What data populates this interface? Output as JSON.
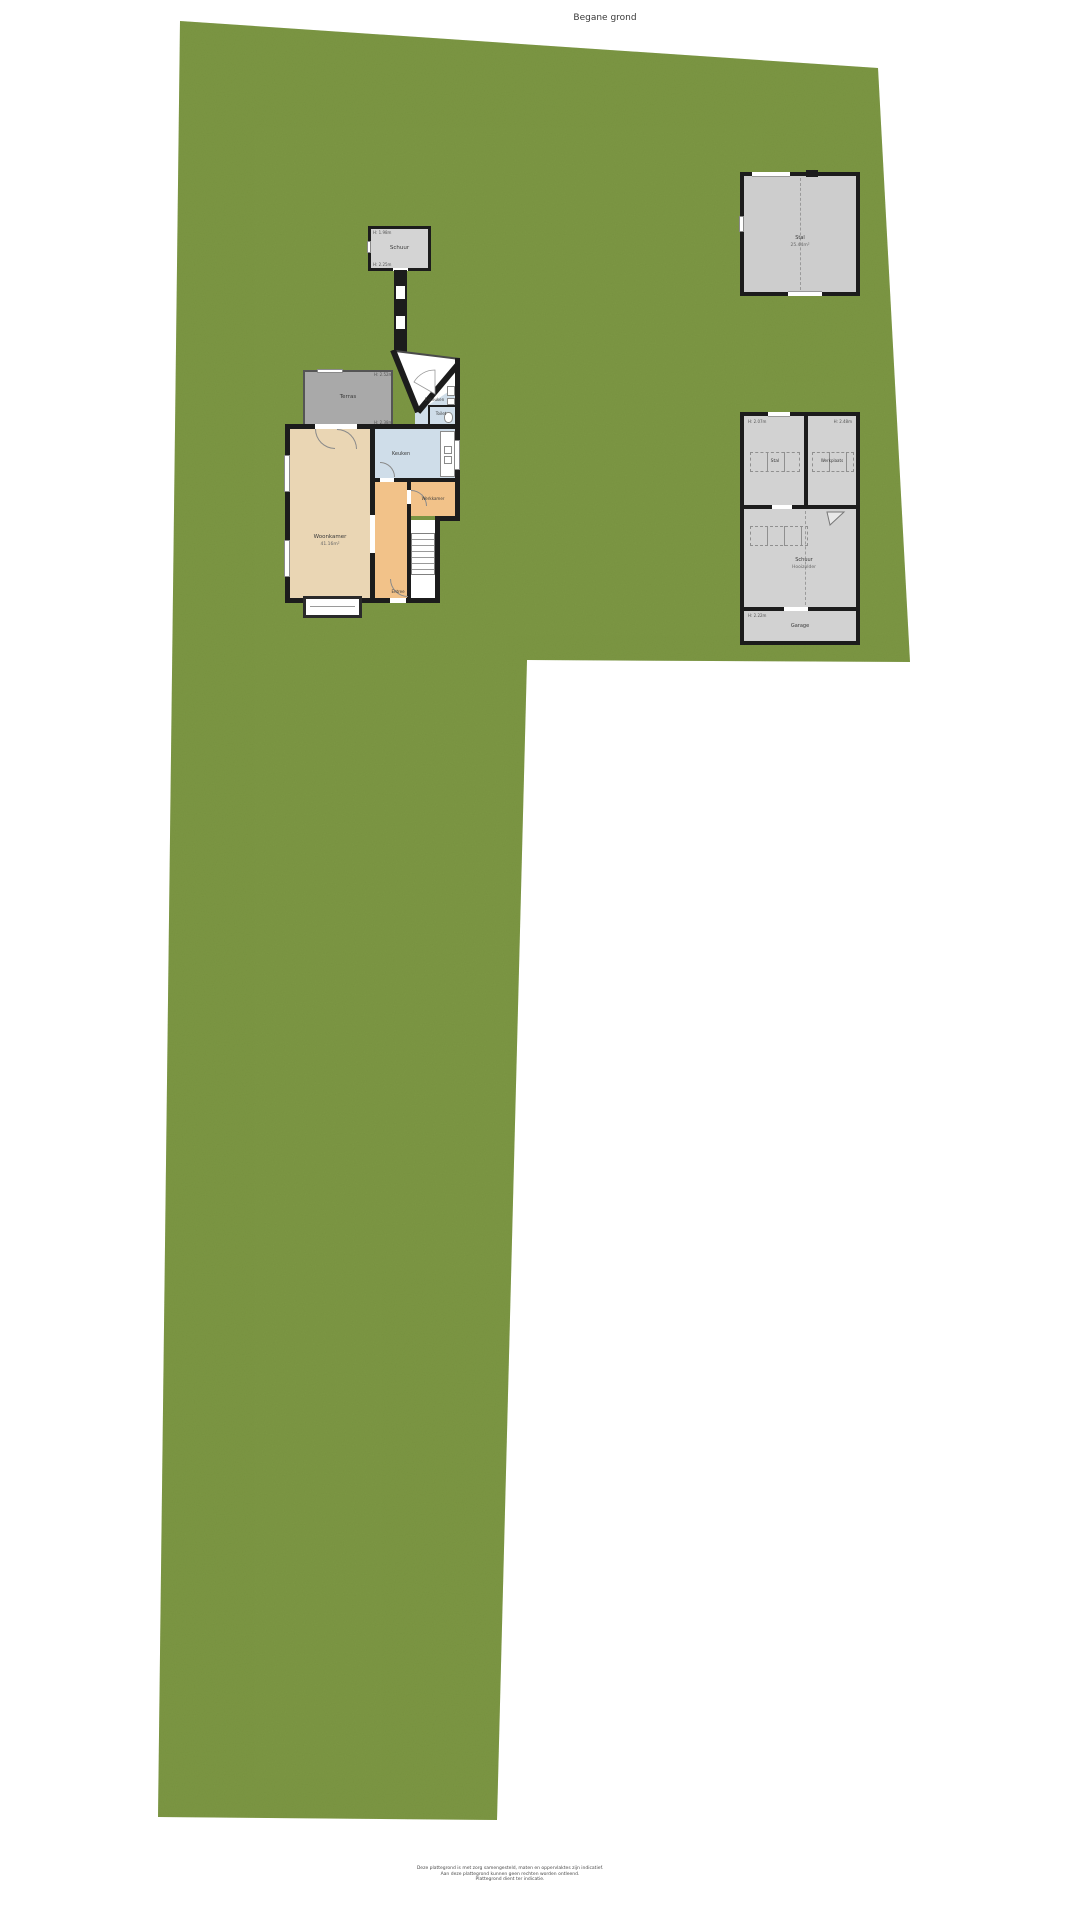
{
  "title": "Begane grond",
  "colors": {
    "grass": "#7d9845",
    "wall": "#1c1c1c",
    "outbuilding_floor": "#d2d2d2",
    "terras_gray": "#a9a9a9",
    "living_wood": "#ead6b4",
    "hall_orange": "#f2c289",
    "wet_room_blue": "#cfdde9"
  },
  "garden_shed": {
    "name": "Schuur",
    "dim_top": "H: 1.98m",
    "dim_bottom": "H: 2.25m"
  },
  "house": {
    "terras": {
      "name": "Terras"
    },
    "bijkeuken": {
      "name": "Bijkeuken"
    },
    "toilet": {
      "name": "Toilet"
    },
    "keuken": {
      "name": "Keuken"
    },
    "woonkamer": {
      "name": "Woonkamer",
      "area": "41.16m²"
    },
    "werkkamer": {
      "name": "Werkkamer"
    },
    "entree": {
      "name": "Entree"
    },
    "dim_top": "H: 2.52m",
    "dim_mid": "H: 2.38m"
  },
  "stal_building": {
    "name": "Stal",
    "area": "25.44m²"
  },
  "barn": {
    "stal": {
      "name": "Stal",
      "dim": "H: 2.07m"
    },
    "werkplaats": {
      "name": "Werkplaats",
      "dim": "H: 2.48m"
    },
    "schuur": {
      "name": "Schuur",
      "sub": "Hooizolder"
    },
    "garage": {
      "name": "Garage",
      "dim": "H: 2.22m"
    }
  },
  "disclaimer": {
    "line1": "Deze plattegrond is met zorg samengesteld, maten en oppervlaktes zijn indicatief.",
    "line2": "Aan deze plattegrond kunnen geen rechten worden ontleend.",
    "line3": "Plattegrond dient ter indicatie."
  }
}
